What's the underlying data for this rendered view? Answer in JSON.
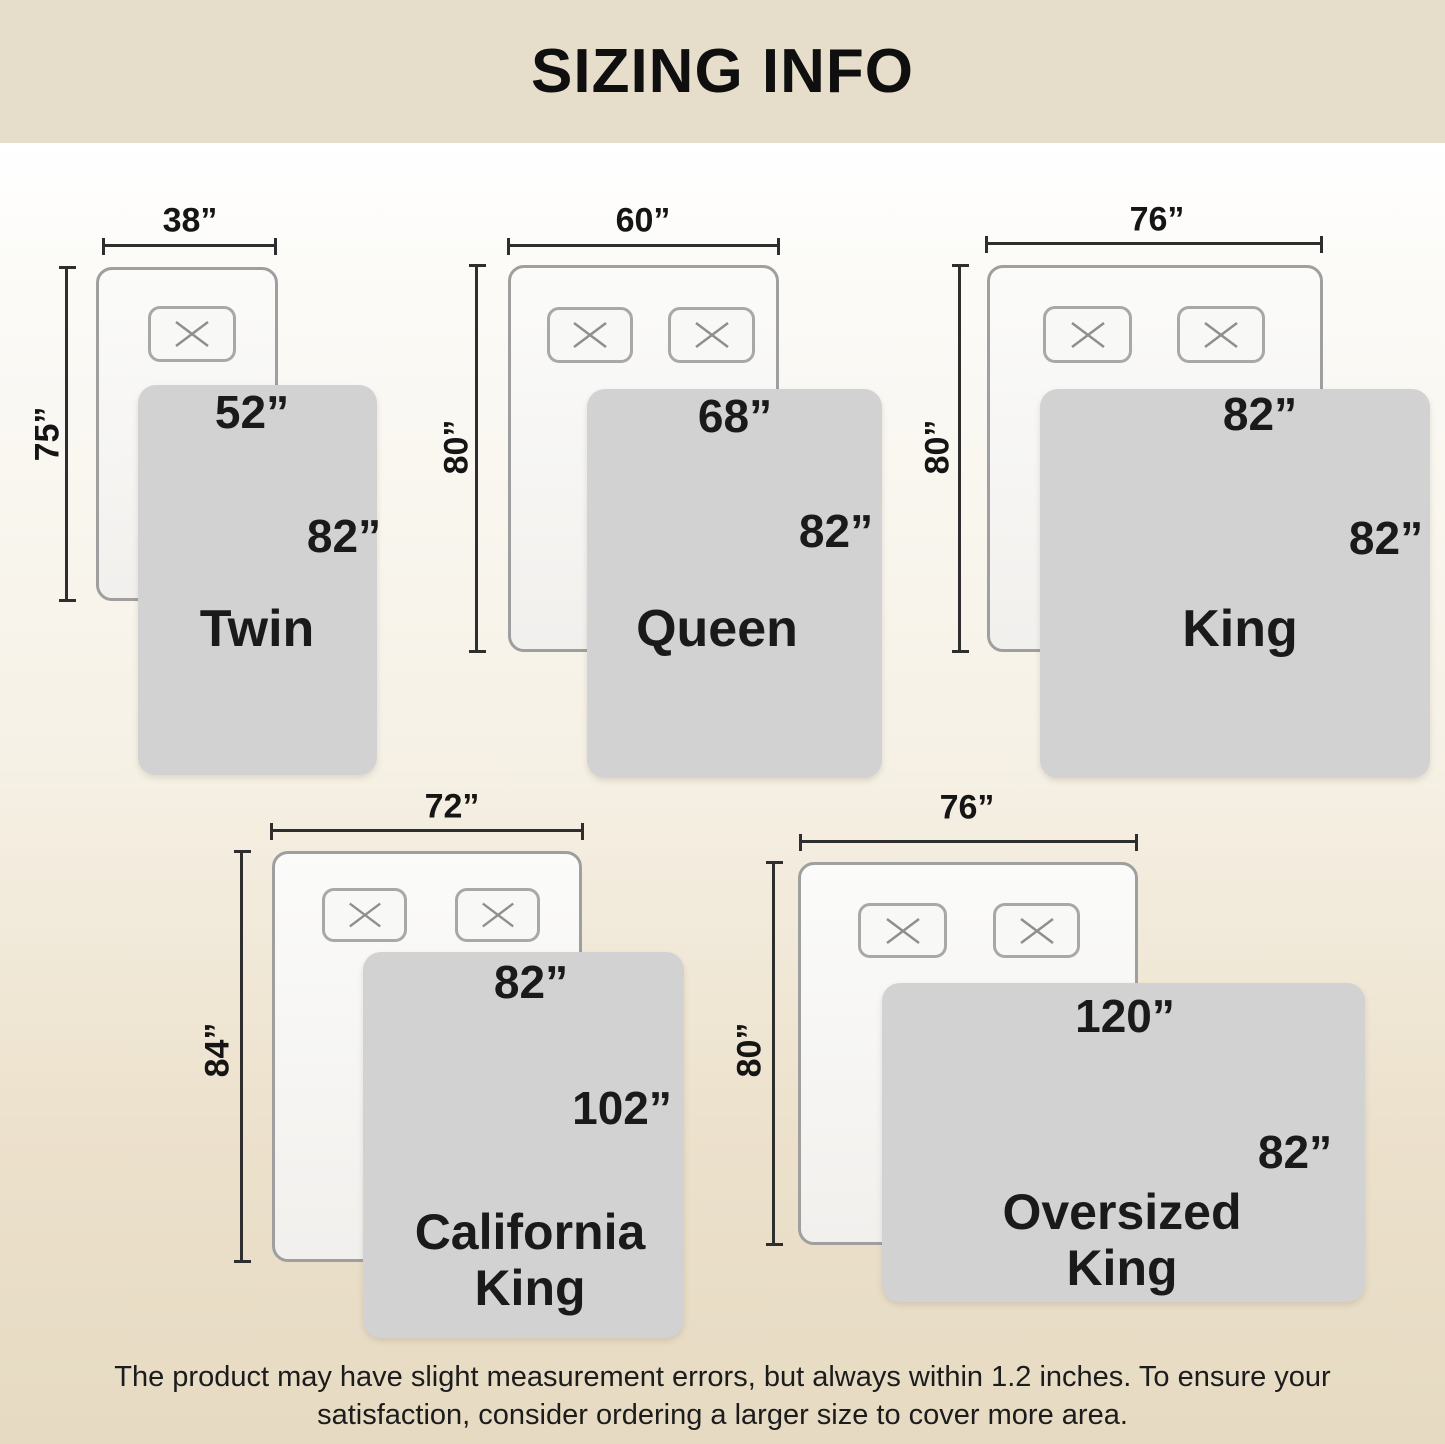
{
  "title": "SIZING INFO",
  "sizes": [
    {
      "name": "Twin",
      "bed_width": "38”",
      "bed_length": "75”",
      "blanket_width": "52”",
      "blanket_length": "82”",
      "pillow_count": 1
    },
    {
      "name": "Queen",
      "bed_width": "60”",
      "bed_length": "80”",
      "blanket_width": "68”",
      "blanket_length": "82”",
      "pillow_count": 2
    },
    {
      "name": "King",
      "bed_width": "76”",
      "bed_length": "80”",
      "blanket_width": "82”",
      "blanket_length": "82”",
      "pillow_count": 2
    },
    {
      "name": "California King",
      "bed_width": "72”",
      "bed_length": "84”",
      "blanket_width": "82”",
      "blanket_length": "102”",
      "pillow_count": 2
    },
    {
      "name": "Oversized King",
      "bed_width": "76”",
      "bed_length": "80”",
      "blanket_width": "120”",
      "blanket_length": "82”",
      "pillow_count": 2
    }
  ],
  "footer": {
    "line1": "The product may have slight measurement errors, but always within 1.2 inches. To ensure your",
    "line2": "satisfaction, consider ordering a larger size to cover more area."
  },
  "colors": {
    "header_bg": "#e6ddca",
    "body_bottom_bg": "#e6dac2",
    "blanket_fill": "#d2d2d3",
    "bed_border": "#9f9f9f",
    "dimension_line": "#2e2e2e",
    "text": "#1a1a1a"
  }
}
